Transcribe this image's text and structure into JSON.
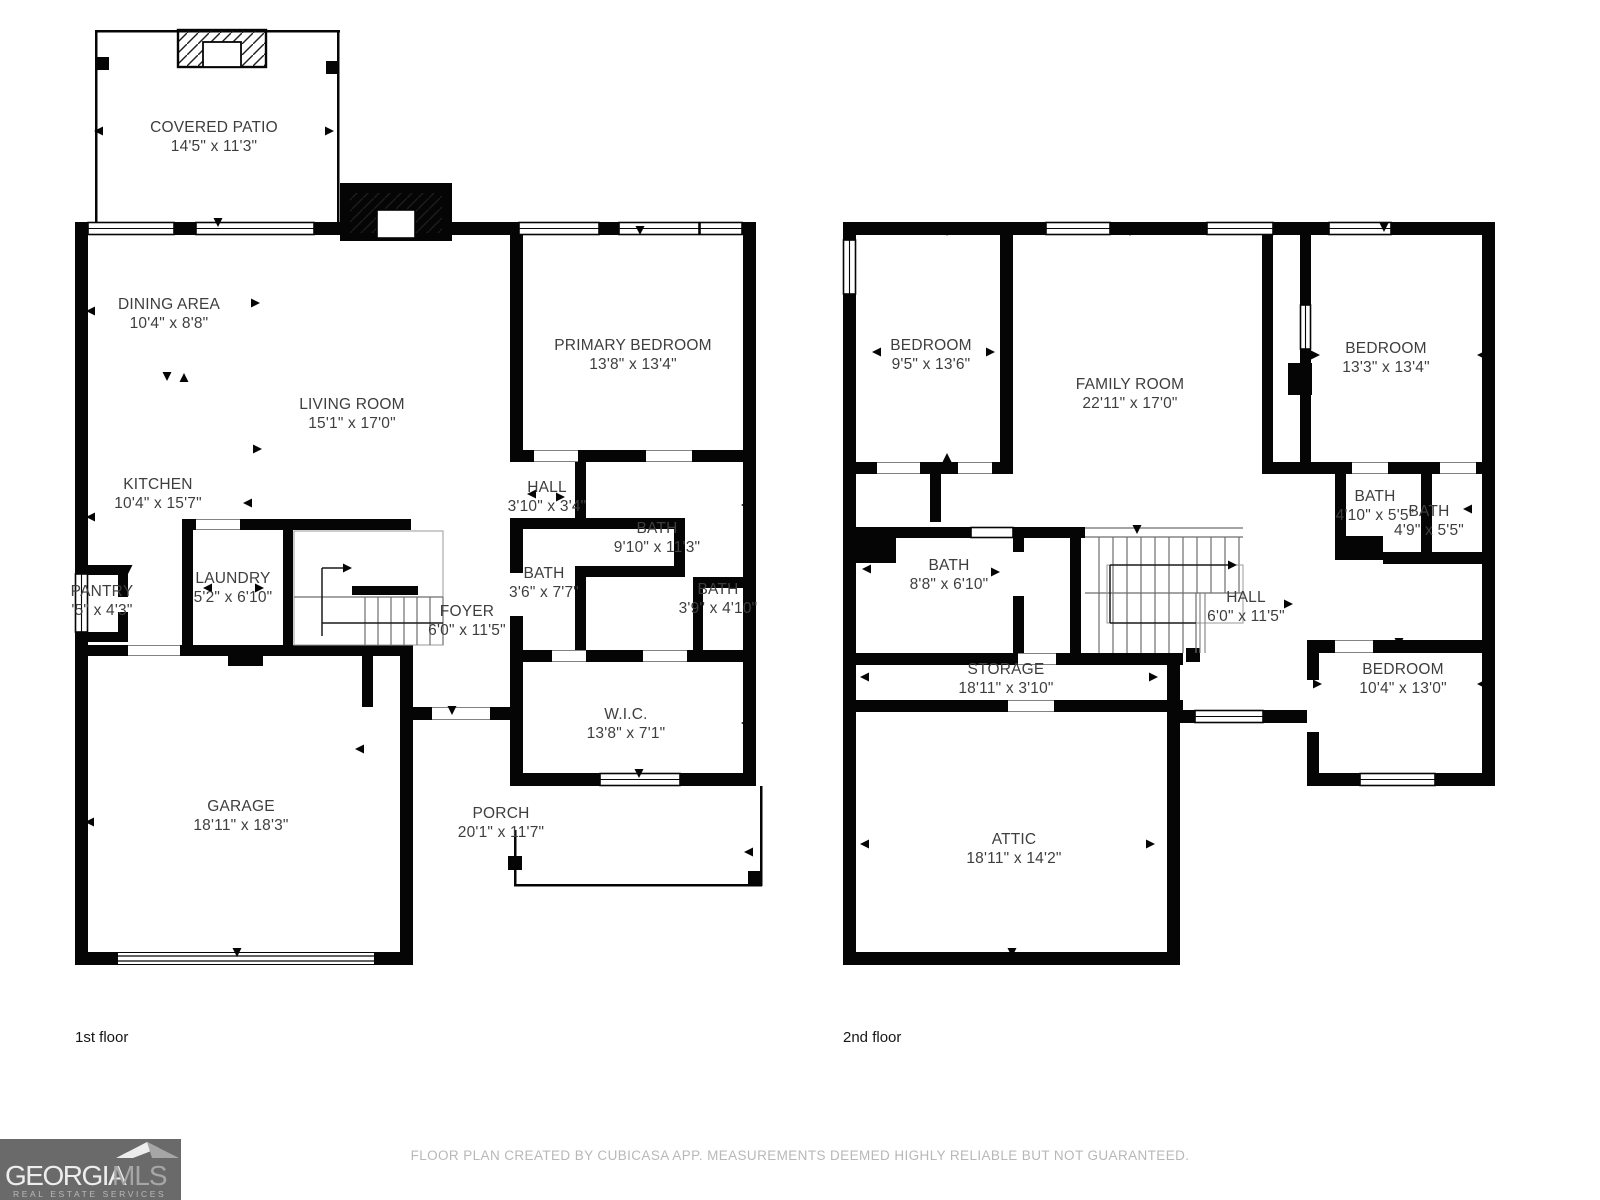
{
  "floors": [
    {
      "label": "1st floor",
      "rooms": [
        {
          "name": "COVERED PATIO",
          "dims": "14'5\" x 11'3\""
        },
        {
          "name": "DINING AREA",
          "dims": "10'4\" x 8'8\""
        },
        {
          "name": "LIVING ROOM",
          "dims": "15'1\" x 17'0\""
        },
        {
          "name": "KITCHEN",
          "dims": "10'4\" x 15'7\""
        },
        {
          "name": "PANTRY",
          "dims": "'5\" x 4'3\""
        },
        {
          "name": "LAUNDRY",
          "dims": "5'2\" x 6'10\""
        },
        {
          "name": "FOYER",
          "dims": "6'0\" x 11'5\""
        },
        {
          "name": "HALL",
          "dims": "3'10\" x 3'4\""
        },
        {
          "name": "BATH",
          "dims": "9'10\" x 11'3\""
        },
        {
          "name": "BATH",
          "dims": "3'6\" x 7'7\""
        },
        {
          "name": "BATH",
          "dims": "3'9\" x 4'10\""
        },
        {
          "name": "W.I.C.",
          "dims": "13'8\" x 7'1\""
        },
        {
          "name": "PORCH",
          "dims": "20'1\" x 11'7\""
        },
        {
          "name": "GARAGE",
          "dims": "18'11\" x 18'3\""
        },
        {
          "name": "PRIMARY BEDROOM",
          "dims": "13'8\" x 13'4\""
        }
      ]
    },
    {
      "label": "2nd floor",
      "rooms": [
        {
          "name": "BEDROOM",
          "dims": "9'5\" x 13'6\""
        },
        {
          "name": "FAMILY ROOM",
          "dims": "22'11\" x 17'0\""
        },
        {
          "name": "BEDROOM",
          "dims": "13'3\" x 13'4\""
        },
        {
          "name": "BATH",
          "dims": "4'10\" x 5'5\""
        },
        {
          "name": "BATH",
          "dims": "4'9\" x 5'5\""
        },
        {
          "name": "BATH",
          "dims": "8'8\" x 6'10\""
        },
        {
          "name": "HALL",
          "dims": "6'0\" x 11'5\""
        },
        {
          "name": "STORAGE",
          "dims": "18'11\" x 3'10\""
        },
        {
          "name": "BEDROOM",
          "dims": "10'4\" x 13'0\""
        },
        {
          "name": "ATTIC",
          "dims": "18'11\" x 14'2\""
        }
      ]
    }
  ],
  "footer": {
    "disclaimer": "FLOOR PLAN CREATED BY CUBICASA APP. MEASUREMENTS DEEMED HIGHLY RELIABLE BUT NOT GUARANTEED."
  },
  "logo": {
    "brand": "GEORGIA",
    "suffix": "MLS",
    "tagline": "REAL ESTATE SERVICES"
  },
  "colors": {
    "wall": "#050505",
    "label_text": "#3e3e3e",
    "floor_label_text": "#161616",
    "footer_text": "#b8b8b8",
    "logo_background": "#6a6a6a",
    "logo_brand": "#ededed",
    "logo_suffix": "#a6a6a6"
  }
}
